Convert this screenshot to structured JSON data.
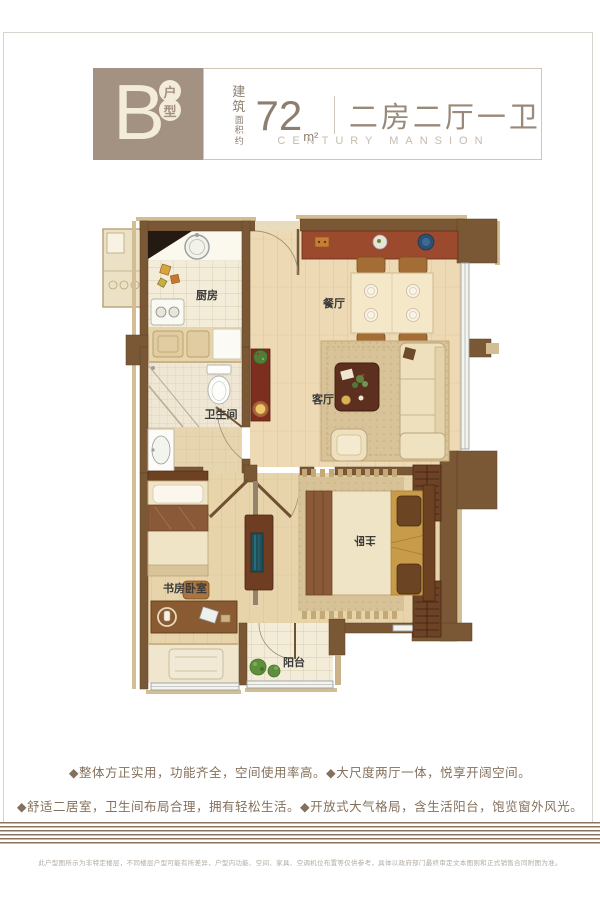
{
  "header": {
    "unit_letter": "B",
    "unit_tags": [
      "户",
      "型"
    ],
    "area_label_1": "建筑",
    "area_label_2": "面积约",
    "area_value": "72",
    "area_unit": "m²",
    "title": "二房二厅一卫",
    "subtitle": "CENTURY MANSION"
  },
  "floorplan": {
    "rooms": {
      "kitchen": "厨房",
      "dining": "餐厅",
      "living": "客厅",
      "bath": "卫生间",
      "study": "书房卧室",
      "master": "主卧",
      "balcony": "阳台"
    }
  },
  "features": {
    "line1": "◆整体方正实用，功能齐全，空间使用率高。◆大尺度两厅一体，悦享开阔空间。",
    "line2": "◆舒适二居室，卫生间布局合理，拥有轻松生活。◆开放式大气格局，含生活阳台，饱览窗外风光。"
  },
  "disclaimer": {
    "text": "此户型图所示为非特定楼层，不同楼层户型可能有所差异，户型内功能、空间、家具、空调机位布置等仅供参考，具体以政府部门最终审定文本图则和正式销售合同附图为准。"
  },
  "colors": {
    "wall_brown": "#7a5836",
    "wall_tan": "#d3bd92",
    "floor_wood": "#ecd9b2",
    "header_taupe": "#a39181",
    "accent_red_cabinet": "#7d2f1f",
    "feature_text": "#84705c",
    "stripe_band": "#8d745c"
  }
}
